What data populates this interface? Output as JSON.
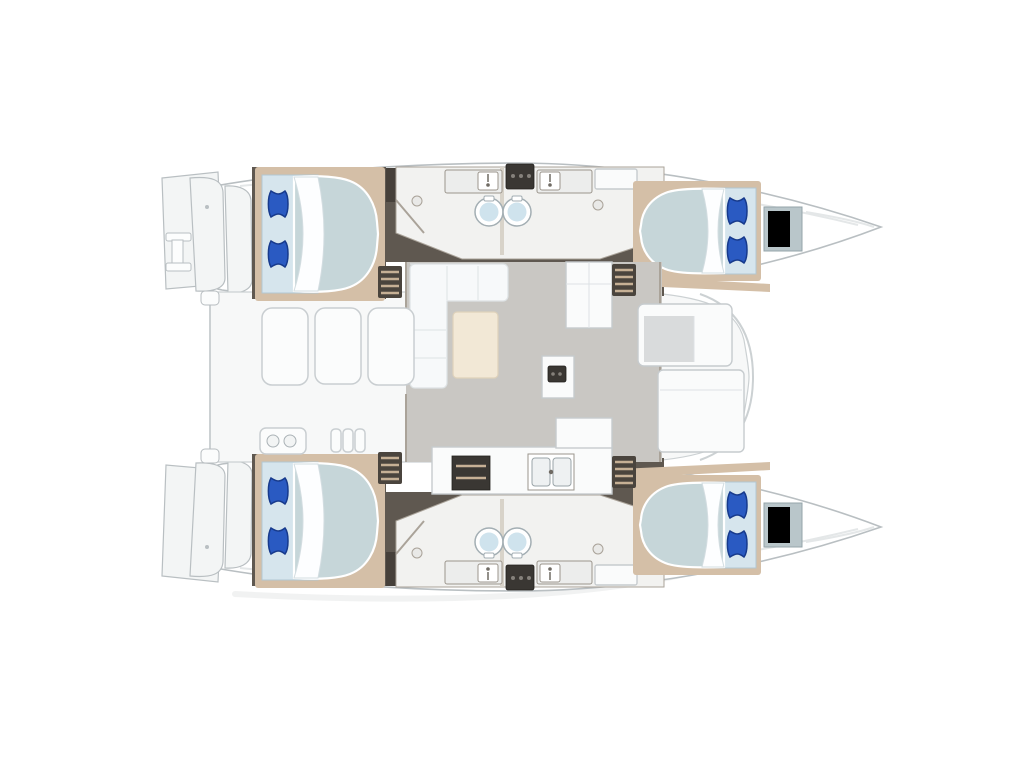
{
  "canvas": {
    "background": "#ffffff",
    "width": 1024,
    "height": 768
  },
  "colors": {
    "hullFill": "#ffffff",
    "hullStroke": "#b9bfc2",
    "hullInner": "#e4e7e8",
    "deck": "#f7f8f8",
    "deckStroke": "#ccd1d3",
    "transom": "#f3f5f5",
    "corridor": "#5f5850",
    "corridorDark": "#46403a",
    "bathFloor": "#f2f2f0",
    "bathStroke": "#aaa399",
    "trim": "#d4bfa7",
    "wall": "#d8d3c9",
    "salonFloor": "#c9c7c3",
    "furnWhite": "#fafbfb",
    "furnStroke": "#c6cbce",
    "sofa": "#f7f9fa",
    "sofaStroke": "#dde2e4",
    "table": "#f2e8d6",
    "tableStroke": "#ded1ba",
    "mattress": "#c6d6d9",
    "bedBase": "#d6e5ed",
    "bedBaseStroke": "#b2c7d2",
    "sheet": "#fdfeff",
    "sheetStroke": "#d3dde1",
    "pillow": "#2a5ac2",
    "pillowDark": "#173a8c",
    "toiletStroke": "#a3aeb3",
    "toiletInner": "#cfe3ed",
    "shower": "#ecedec",
    "showerStroke": "#9b958c",
    "hatch": "#3a3733",
    "hatchKnob": "#85817b",
    "window": "#b9c6ca",
    "windowStroke": "#95a4aa",
    "recess": "#d9dbdc",
    "steps": "#4a443d",
    "stepsRung": "#c6b095",
    "cushion": "#fbfcfc",
    "cushionStroke": "#c9ced1",
    "sink": "#eef1f2",
    "sinkStroke": "#9aa4a8",
    "shadow": "#eceeee"
  }
}
